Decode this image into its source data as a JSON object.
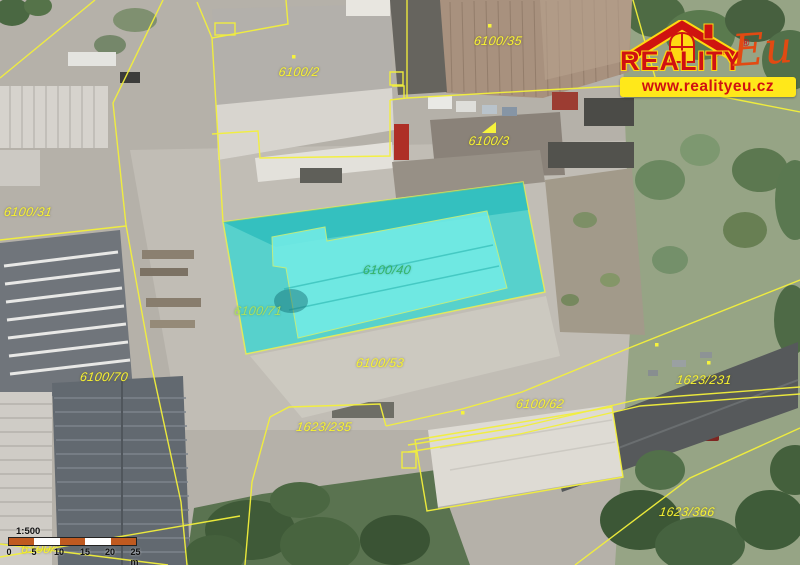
{
  "map": {
    "type": "cadastral-aerial-map",
    "highlight": {
      "highlighted_parcel": "6100/71",
      "highlighted_building": "6100/40",
      "fill_color": "#3dd6d2",
      "outline_color": "#e8f34c"
    },
    "boundary_color": "#f3f03b",
    "label_color": "#f8f332",
    "parcel_labels": [
      {
        "id": "6100/2"
      },
      {
        "id": "6100/35"
      },
      {
        "id": "6100/3"
      },
      {
        "id": "6100/31"
      },
      {
        "id": "6100/40"
      },
      {
        "id": "6100/71"
      },
      {
        "id": "6100/53"
      },
      {
        "id": "6100/70"
      },
      {
        "id": "6100/62"
      },
      {
        "id": "1623/235"
      },
      {
        "id": "1623/231"
      },
      {
        "id": "1623/366"
      },
      {
        "id": "6100/"
      }
    ]
  },
  "logo": {
    "brand": "REALITY",
    "brand_suffix": "Eu",
    "registered": "®",
    "website": "www.realityeu.cz",
    "red": "#d01112",
    "yellow": "#ffe81a"
  },
  "scale_bar": {
    "ratio": "1:500",
    "tick_labels": [
      "0",
      "5",
      "10",
      "15",
      "20",
      "25 m"
    ],
    "segment_color": "#c05a20"
  }
}
